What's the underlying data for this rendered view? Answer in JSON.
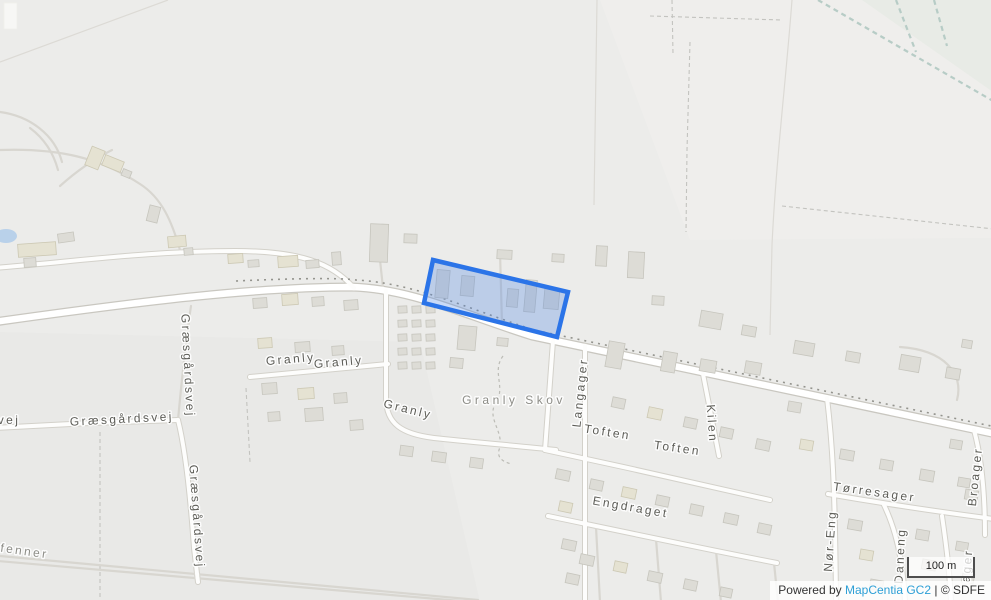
{
  "map": {
    "background": "#ececea",
    "attribution": {
      "prefix": "Powered by ",
      "link": "MapCentia GC2",
      "suffix": " | © SDFE",
      "link_color": "#2d9fd6",
      "text_color": "#333333"
    },
    "scalebar": {
      "label": "100 m"
    },
    "highlight": {
      "points": "433,260 568,292 557,337 424,303",
      "stroke": "#2b74e8",
      "fill": "rgba(77,134,230,0.30)",
      "stroke_width": 4.5
    },
    "fields": [
      [
        "600,0 993,0 993,238 690,240",
        "#efeeec"
      ],
      [
        "862,0 993,0 993,92",
        "#e8ebe6"
      ],
      [
        "0,332 420,342 480,602 0,602",
        "#e9e9e7"
      ]
    ],
    "pond": {
      "cx": 6,
      "cy": 236,
      "rx": 11,
      "ry": 7,
      "fill": "#b9d1ea"
    },
    "streams": [
      "M818,0 L993,101",
      "M896,0 L916,52",
      "M934,0 L947,46"
    ],
    "faint_lines": [
      "M792,0 C786,80 776,160 772,245 L770,335",
      "M0,62 L168,0",
      "M597,0 L594,205"
    ],
    "boundaries": [
      "M100,432 L100,602",
      "M650,16 L782,20",
      "M672,0 L673,54",
      "M690,42 L687,150 L686,232",
      "M782,206 L994,229",
      "M246,388 L250,462"
    ],
    "skov_outline": "M503,356 C491,372 507,388 495,404 C487,420 505,432 499,450 C497,457 502,462 512,464",
    "road_dash": "M236,281 C300,278 344,278 356,280 C414,283 466,308 534,330 L996,427",
    "roads": [
      [
        "M",
        "M-6,322 C150,300 260,287 352,287 C412,289 462,314 532,336 L996,434"
      ],
      [
        "S",
        "M-6,268 C80,261 150,251 235,251 C300,251 332,263 354,288"
      ],
      [
        "S",
        "M-6,428 L90,423 L178,420"
      ],
      [
        "S",
        "M178,420 C186,452 191,505 194,548 L198,582"
      ],
      [
        "T",
        "M178,420 C181,388 185,345 191,306"
      ],
      [
        "S",
        "M250,377 L388,364"
      ],
      [
        "S",
        "M386,291 L386,398 C386,424 402,434 434,438 C470,442 520,446 556,450"
      ],
      [
        "S",
        "M585,346 L585,602"
      ],
      [
        "S",
        "M553,341 L545,450"
      ],
      [
        "S",
        "M545,450 C620,466 700,484 770,500"
      ],
      [
        "S",
        "M548,516 C620,531 700,548 777,563"
      ],
      [
        "S",
        "M703,374 L719,456"
      ],
      [
        "S",
        "M828,494 C880,503 940,512 994,519"
      ],
      [
        "S",
        "M827,398 C832,440 835,480 836,602"
      ],
      [
        "S",
        "M884,505 C896,530 903,560 905,602"
      ],
      [
        "S",
        "M974,430 C981,456 985,492 985,535"
      ],
      [
        "S",
        "M942,516 C947,550 950,575 951,602"
      ],
      [
        "T",
        "M596,527 L600,602"
      ],
      [
        "T",
        "M656,539 L661,602"
      ],
      [
        "T",
        "M716,551 L721,602"
      ],
      [
        "T",
        "M774,563 L778,602"
      ],
      [
        "T",
        "M500,252 L502,324"
      ],
      [
        "T",
        "M0,150 C60,148 100,158 140,184 C162,198 172,222 180,250"
      ],
      [
        "T",
        "M60,186 C80,168 96,158 112,150"
      ],
      [
        "T",
        "M30,128 C46,140 54,155 58,170"
      ],
      [
        "T",
        "M0,112 C30,116 55,135 62,162"
      ],
      [
        "T",
        "M380,260 L383,288"
      ],
      [
        "T",
        "M900,347 C945,350 964,374 957,400"
      ],
      [
        "T",
        "M0,556 L478,600"
      ],
      [
        "T",
        "M-2,561 L472,602"
      ]
    ],
    "buildings": [
      [
        4,
        3,
        13,
        26,
        0,
        2
      ],
      [
        18,
        243,
        38,
        13,
        -4,
        1
      ],
      [
        24,
        258,
        12,
        9,
        -4,
        0
      ],
      [
        58,
        233,
        16,
        9,
        -8,
        0
      ],
      [
        88,
        148,
        14,
        20,
        22,
        1
      ],
      [
        103,
        158,
        20,
        11,
        22,
        1
      ],
      [
        122,
        170,
        9,
        7,
        22,
        0
      ],
      [
        148,
        206,
        11,
        16,
        14,
        0
      ],
      [
        168,
        236,
        18,
        11,
        -5,
        1
      ],
      [
        184,
        248,
        9,
        7,
        -5,
        0
      ],
      [
        228,
        254,
        15,
        9,
        -4,
        1
      ],
      [
        248,
        260,
        11,
        7,
        -4,
        0
      ],
      [
        278,
        256,
        20,
        11,
        -4,
        1
      ],
      [
        306,
        260,
        13,
        8,
        -4,
        0
      ],
      [
        332,
        252,
        9,
        13,
        -4,
        0
      ],
      [
        370,
        224,
        18,
        38,
        2,
        0
      ],
      [
        404,
        234,
        13,
        9,
        2,
        0
      ],
      [
        497,
        250,
        15,
        9,
        3,
        0
      ],
      [
        552,
        254,
        12,
        8,
        3,
        0
      ],
      [
        596,
        246,
        11,
        20,
        3,
        0
      ],
      [
        628,
        252,
        16,
        26,
        3,
        0
      ],
      [
        652,
        296,
        12,
        9,
        3,
        0
      ],
      [
        700,
        312,
        22,
        16,
        10,
        0
      ],
      [
        742,
        326,
        14,
        10,
        10,
        0
      ],
      [
        794,
        342,
        20,
        13,
        10,
        0
      ],
      [
        846,
        352,
        14,
        10,
        10,
        0
      ],
      [
        900,
        356,
        20,
        15,
        10,
        0
      ],
      [
        946,
        368,
        14,
        11,
        10,
        0
      ],
      [
        962,
        340,
        10,
        8,
        10,
        0
      ],
      [
        436,
        270,
        13,
        28,
        5,
        0
      ],
      [
        461,
        276,
        13,
        20,
        5,
        0
      ],
      [
        507,
        289,
        11,
        18,
        5,
        0
      ],
      [
        525,
        280,
        11,
        32,
        5,
        0
      ],
      [
        544,
        289,
        15,
        20,
        5,
        0
      ],
      [
        458,
        326,
        18,
        24,
        5,
        0
      ],
      [
        497,
        338,
        11,
        8,
        5,
        0
      ],
      [
        253,
        298,
        14,
        10,
        -4,
        0
      ],
      [
        282,
        294,
        16,
        11,
        -4,
        1
      ],
      [
        312,
        297,
        12,
        9,
        -4,
        0
      ],
      [
        344,
        300,
        14,
        10,
        -4,
        0
      ],
      [
        258,
        338,
        14,
        10,
        -4,
        1
      ],
      [
        295,
        342,
        15,
        10,
        -4,
        0
      ],
      [
        332,
        346,
        12,
        9,
        -4,
        0
      ],
      [
        262,
        383,
        15,
        11,
        -4,
        0
      ],
      [
        298,
        388,
        16,
        11,
        -4,
        1
      ],
      [
        334,
        393,
        13,
        10,
        -4,
        0
      ],
      [
        305,
        408,
        18,
        13,
        -4,
        0
      ],
      [
        268,
        412,
        12,
        9,
        -4,
        0
      ],
      [
        350,
        420,
        13,
        10,
        -4,
        0
      ],
      [
        398,
        306,
        9,
        7,
        -3,
        0
      ],
      [
        412,
        306,
        9,
        7,
        -3,
        0
      ],
      [
        426,
        306,
        9,
        7,
        -3,
        0
      ],
      [
        398,
        320,
        9,
        7,
        -3,
        0
      ],
      [
        412,
        320,
        9,
        7,
        -3,
        0
      ],
      [
        426,
        320,
        9,
        7,
        -3,
        0
      ],
      [
        398,
        334,
        9,
        7,
        -3,
        0
      ],
      [
        412,
        334,
        9,
        7,
        -3,
        0
      ],
      [
        426,
        334,
        9,
        7,
        -3,
        0
      ],
      [
        398,
        348,
        9,
        7,
        -3,
        0
      ],
      [
        412,
        348,
        9,
        7,
        -3,
        0
      ],
      [
        426,
        348,
        9,
        7,
        -3,
        0
      ],
      [
        398,
        362,
        9,
        7,
        -3,
        0
      ],
      [
        412,
        362,
        9,
        7,
        -3,
        0
      ],
      [
        426,
        362,
        9,
        7,
        -3,
        0
      ],
      [
        450,
        358,
        13,
        10,
        5,
        0
      ],
      [
        400,
        446,
        13,
        10,
        8,
        0
      ],
      [
        432,
        452,
        14,
        10,
        8,
        0
      ],
      [
        470,
        458,
        13,
        10,
        8,
        0
      ],
      [
        556,
        470,
        14,
        10,
        12,
        0
      ],
      [
        559,
        502,
        13,
        10,
        12,
        1
      ],
      [
        562,
        540,
        14,
        10,
        12,
        0
      ],
      [
        566,
        574,
        13,
        10,
        12,
        0
      ],
      [
        607,
        342,
        16,
        26,
        10,
        0
      ],
      [
        662,
        352,
        14,
        20,
        10,
        0
      ],
      [
        700,
        360,
        16,
        12,
        10,
        0
      ],
      [
        745,
        362,
        16,
        12,
        10,
        0
      ],
      [
        788,
        402,
        13,
        10,
        10,
        0
      ],
      [
        612,
        398,
        13,
        10,
        12,
        0
      ],
      [
        648,
        408,
        14,
        11,
        12,
        1
      ],
      [
        684,
        418,
        13,
        10,
        12,
        0
      ],
      [
        720,
        428,
        13,
        10,
        12,
        0
      ],
      [
        756,
        440,
        14,
        10,
        12,
        0
      ],
      [
        800,
        440,
        13,
        10,
        10,
        1
      ],
      [
        840,
        450,
        14,
        10,
        10,
        0
      ],
      [
        880,
        460,
        13,
        10,
        10,
        0
      ],
      [
        920,
        470,
        14,
        11,
        10,
        0
      ],
      [
        958,
        478,
        12,
        9,
        10,
        0
      ],
      [
        590,
        480,
        13,
        10,
        12,
        0
      ],
      [
        622,
        488,
        14,
        10,
        12,
        1
      ],
      [
        656,
        496,
        13,
        10,
        12,
        0
      ],
      [
        690,
        505,
        13,
        10,
        12,
        0
      ],
      [
        724,
        514,
        14,
        10,
        12,
        0
      ],
      [
        758,
        524,
        13,
        10,
        12,
        0
      ],
      [
        580,
        555,
        14,
        10,
        12,
        0
      ],
      [
        614,
        562,
        13,
        10,
        12,
        1
      ],
      [
        648,
        572,
        14,
        10,
        12,
        0
      ],
      [
        684,
        580,
        13,
        10,
        12,
        0
      ],
      [
        720,
        588,
        12,
        9,
        12,
        0
      ],
      [
        848,
        520,
        14,
        10,
        10,
        0
      ],
      [
        860,
        550,
        13,
        10,
        10,
        1
      ],
      [
        870,
        580,
        13,
        10,
        10,
        0
      ],
      [
        916,
        530,
        13,
        10,
        10,
        0
      ],
      [
        922,
        560,
        14,
        10,
        10,
        0
      ],
      [
        956,
        542,
        12,
        9,
        10,
        0
      ],
      [
        962,
        574,
        12,
        9,
        10,
        0
      ],
      [
        950,
        440,
        12,
        9,
        10,
        0
      ],
      [
        965,
        490,
        13,
        10,
        10,
        0
      ]
    ],
    "labels": [
      {
        "t": "Granly",
        "x": 291,
        "y": 363,
        "r": -5
      },
      {
        "t": "Granly",
        "x": 339,
        "y": 366,
        "r": -5
      },
      {
        "t": "Granly",
        "x": 407,
        "y": 413,
        "r": 14
      },
      {
        "t": "Granly Skov",
        "x": 514,
        "y": 404,
        "r": 0,
        "ls": 3.5,
        "c": "#8d8d87"
      },
      {
        "t": "vej",
        "x": 9,
        "y": 424,
        "r": 0
      },
      {
        "t": "Græsgårdsvej",
        "x": 122,
        "y": 423,
        "r": -3
      },
      {
        "t": "Græsgårdsvej",
        "x": 184,
        "y": 366,
        "r": 87
      },
      {
        "t": "Græsgårdsvej",
        "x": 193,
        "y": 517,
        "r": 86
      },
      {
        "t": "Langager",
        "x": 584,
        "y": 393,
        "r": -84
      },
      {
        "t": "Toften",
        "x": 607,
        "y": 436,
        "r": 9
      },
      {
        "t": "Toften",
        "x": 677,
        "y": 452,
        "r": 8
      },
      {
        "t": "Engdraget",
        "x": 630,
        "y": 511,
        "r": 10
      },
      {
        "t": "Kilen",
        "x": 708,
        "y": 424,
        "r": 86
      },
      {
        "t": "Tørresager",
        "x": 874,
        "y": 496,
        "r": 8
      },
      {
        "t": "Broager",
        "x": 979,
        "y": 477,
        "r": -84
      },
      {
        "t": "Nør-Eng",
        "x": 834,
        "y": 541,
        "r": -86
      },
      {
        "t": "Daneng",
        "x": 904,
        "y": 556,
        "r": -87
      },
      {
        "t": "ager",
        "x": 971,
        "y": 566,
        "r": -85
      },
      {
        "t": "fenner",
        "x": 24,
        "y": 555,
        "r": 8,
        "c": "#8d8d87"
      }
    ]
  }
}
